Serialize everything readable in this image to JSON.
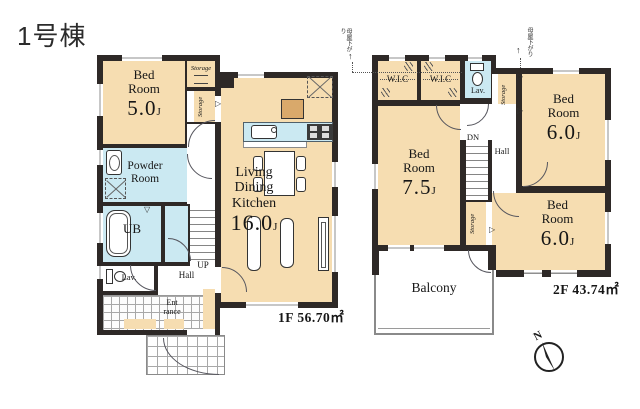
{
  "title": "1号棟",
  "compass_label": "N",
  "icons": {
    "tri_right": "▷",
    "tri_down": "▽",
    "arrow_up": "↑"
  },
  "floor1": {
    "area": "1F 56.70㎡",
    "bedroom": {
      "l1": "Bed",
      "l2": "Room",
      "size": "5.0",
      "unit": "J"
    },
    "storage1": "Storage",
    "storage2": "Storage",
    "powder": {
      "l1": "Powder",
      "l2": "Room"
    },
    "ub": "UB",
    "lav": "Lav.",
    "hall": "Hall",
    "up": "UP",
    "entrance": {
      "l1": "Ent",
      "l2": "rance"
    },
    "ldk": {
      "l1": "Living",
      "l2": "Dining",
      "l3": "Kitchen",
      "size": "16.0",
      "unit": "J"
    }
  },
  "floor2": {
    "area": "2F 43.74㎡",
    "wic1": "W.I.C",
    "wic2": "W.I.C",
    "lav": "Lav.",
    "storage1": "Storage",
    "storage2": "Storage",
    "bedroom_top": {
      "l1": "Bed",
      "l2": "Room",
      "size": "6.0",
      "unit": "J"
    },
    "bedroom_left": {
      "l1": "Bed",
      "l2": "Room",
      "size": "7.5",
      "unit": "J"
    },
    "bedroom_bottom": {
      "l1": "Bed",
      "l2": "Room",
      "size": "6.0",
      "unit": "J"
    },
    "dn": "DN",
    "hall": "Hall",
    "balcony": "Balcony",
    "eaves_note": "母屋下がり"
  },
  "colors": {
    "floor_tan": "#f6ddb1",
    "wet_blue": "#cbe9f2",
    "wall": "#2e2927",
    "wood": "#d9a96b"
  }
}
